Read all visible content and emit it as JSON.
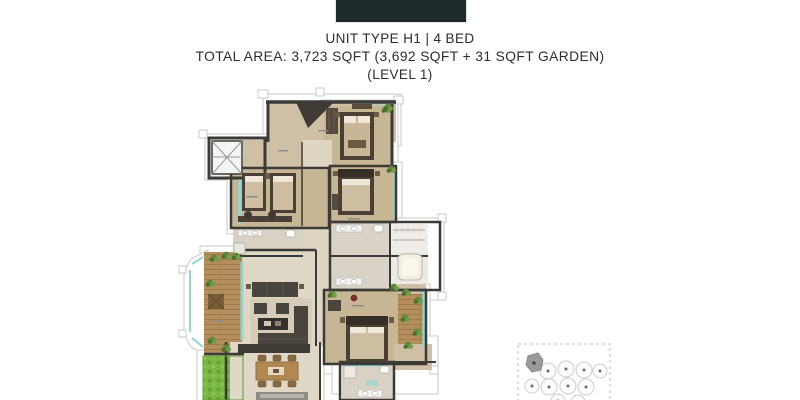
{
  "header": {
    "unit_type": "UNIT TYPE H1 | 4 BED",
    "total_area": "TOTAL AREA: 3,723 SQFT (3,692 SQFT + 31 SQFT GARDEN)",
    "level": "(LEVEL 1)"
  },
  "colors": {
    "logo_box": "#1e2a29",
    "heading_text": "#2d2d2d",
    "wall_dark": "#3b3a36",
    "floor_beige": "#cfc0a5",
    "floor_tan": "#c6b694",
    "floor_cream": "#e0d8c6",
    "glass_teal": "#8ed8d5",
    "deck_wood": "#b58e5d",
    "garden_green": "#79b844",
    "outline_gray": "#c9c9c9",
    "keyplan_gray": "#cdcdcd",
    "keyplan_highlight": "#9a9a9a"
  },
  "floor_plan": {
    "features": "entry hall, elevator, three bedrooms, master bedroom, bathrooms, walk-in closet, living room, dining area, deck with bay window, side terrace, garden strip"
  },
  "key_plan": {
    "style": "dashed-boundary site plan",
    "buildings_visible": 10,
    "highlighted_building": "top-left"
  }
}
